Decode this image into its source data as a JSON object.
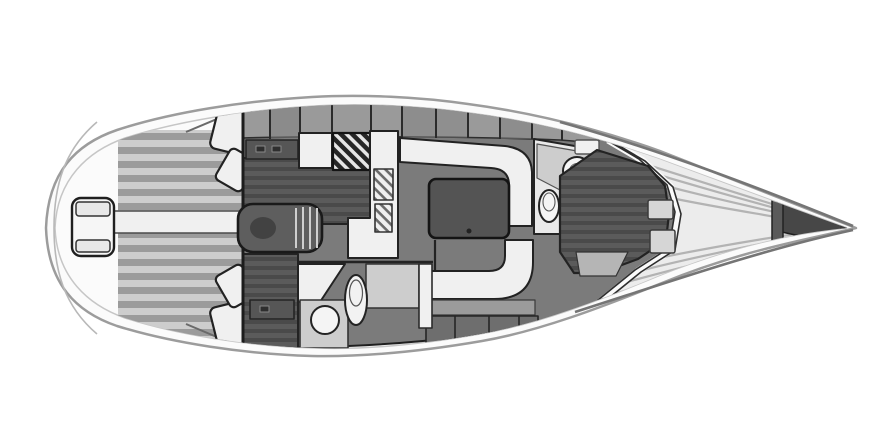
{
  "canvas": {
    "width": 890,
    "height": 446,
    "background": "#ffffff",
    "content_type": "sailing-yacht-interior-floor-plan",
    "orientation": "bow-right-stern-left"
  },
  "colors": {
    "background": "#ffffff",
    "hull_fill": "#fbfbfb",
    "hull_outline": "#9c9c9c",
    "hull_inner_line": "#c6c6c6",
    "bow_sheer": "#757575",
    "interior_floor": "#7b7b7b",
    "bulkhead": "#1f1f1f",
    "furniture_white": "#f0f0f0",
    "furniture_outline": "#222222",
    "locker_band": "#9a9a9a",
    "shelf_dark": "#565656",
    "berth_base": "#5b5b5b",
    "berth_stripe": "#4a4a4a",
    "plank_light": "#cdcdcd",
    "plank_dark": "#9b9b9b",
    "table_fill": "#545454",
    "companionway_fill": "#5e5e5e",
    "counter_gray": "#cdcdcd",
    "under_bench": "#6e6e6e",
    "foredeck_fill": "#ececec",
    "deck_line": "#b3b3b3",
    "anchor_locker": "#474747",
    "berth_insert": "#b5b5b5",
    "ladder_fill": "#f6f6f6"
  },
  "parts": [
    "hull",
    "swim-platform",
    "transom-ladder",
    "cockpit-sole",
    "cockpit-bridge-deck",
    "cockpit-seat-port-1",
    "cockpit-seat-port-2",
    "cockpit-seat-stbd-1",
    "cockpit-seat-stbd-2",
    "companionway-steps",
    "port-aft-cabin-berth",
    "port-aft-cabin-shelf",
    "starboard-aft-cabin-berth",
    "starboard-aft-cabin-shelf",
    "galley-counter",
    "galley-stove",
    "galley-sink",
    "salon-u-settee",
    "salon-table",
    "salon-bench",
    "salon-lockers",
    "aft-head-room",
    "aft-head-toilet",
    "aft-head-sink",
    "forward-head-room",
    "forward-head-toilet",
    "forward-head-sink",
    "v-berth",
    "v-berth-insert",
    "v-berth-foot-lockers",
    "side-lockers-band",
    "foredeck",
    "deck-hatch",
    "anchor-locker",
    "windlass",
    "bow-tip"
  ]
}
